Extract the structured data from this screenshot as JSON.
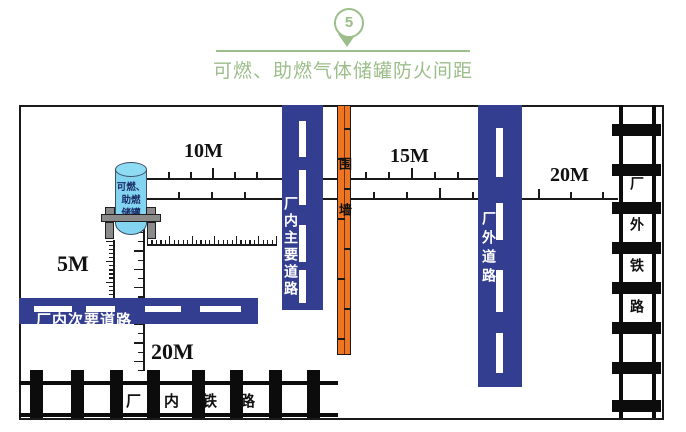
{
  "header": {
    "badge_number": "5",
    "title": "可燃、助燃气体储罐防火间距"
  },
  "colors": {
    "accent_green": "#9cbe8a",
    "road_blue": "#333e90",
    "wall_orange": "#ee7623",
    "tank_blue": "#82d4f0"
  },
  "tank": {
    "lines": [
      "可燃、",
      "助燃",
      "储罐"
    ]
  },
  "distances": {
    "tank_to_main_road": "10M",
    "wall_to_external_road": "15M",
    "external_road_to_external_railway": "20M",
    "tank_to_secondary_road": "5M",
    "tank_to_internal_railway": "20M"
  },
  "features": {
    "internal_main_road": "厂内主要道路",
    "boundary_wall": "围墙",
    "external_road": "厂外道路",
    "external_railway": "厂外铁路",
    "internal_secondary_road": "厂内次要道路",
    "internal_railway": "厂内铁路"
  }
}
